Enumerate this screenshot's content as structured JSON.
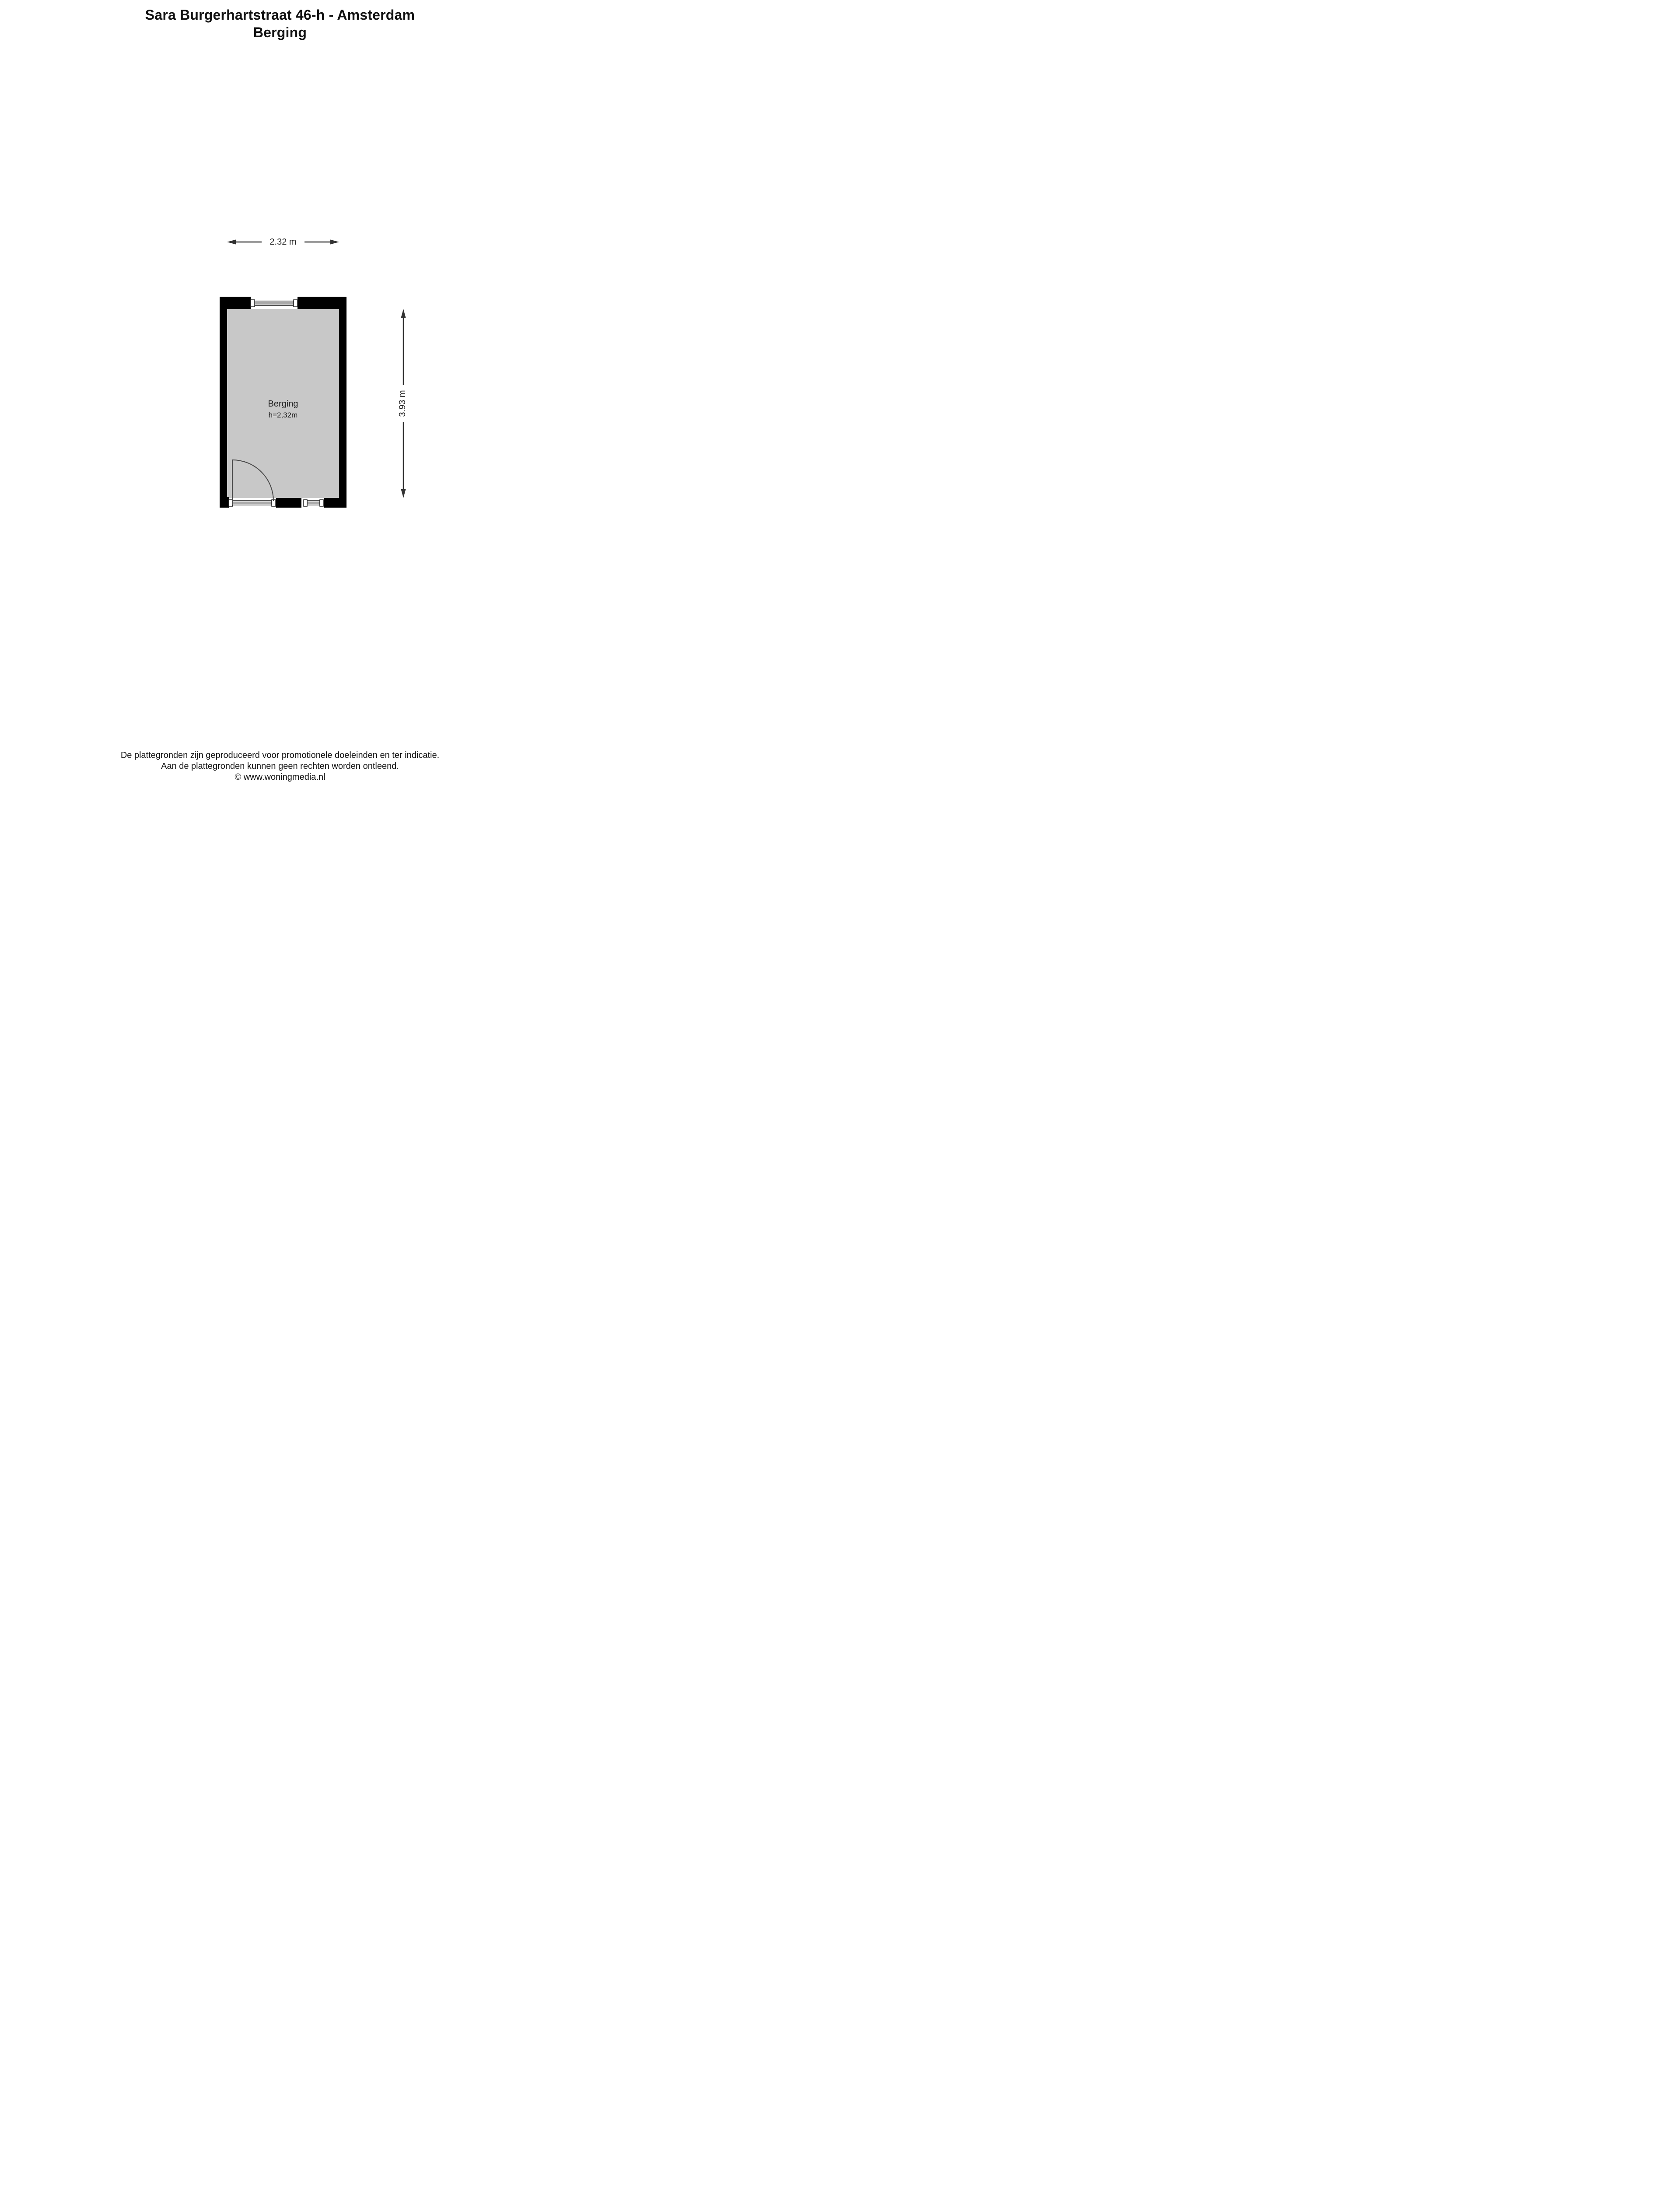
{
  "header": {
    "title": "Sara Burgerhartstraat 46-h - Amsterdam",
    "subtitle": "Berging"
  },
  "floorplan": {
    "room": {
      "name": "Berging",
      "ceiling_height_label": "h=2,32m"
    },
    "dimensions": {
      "width_label": "2.32 m",
      "depth_label": "3.93 m"
    },
    "colors": {
      "wall": "#000000",
      "floor": "#c8c8c8",
      "background": "#ffffff",
      "line": "#333333"
    }
  },
  "footer": {
    "lines": [
      "De plattegronden zijn geproduceerd voor promotionele doeleinden en ter indicatie.",
      "Aan de plattegronden kunnen geen rechten worden ontleend.",
      "© www.woningmedia.nl"
    ]
  }
}
